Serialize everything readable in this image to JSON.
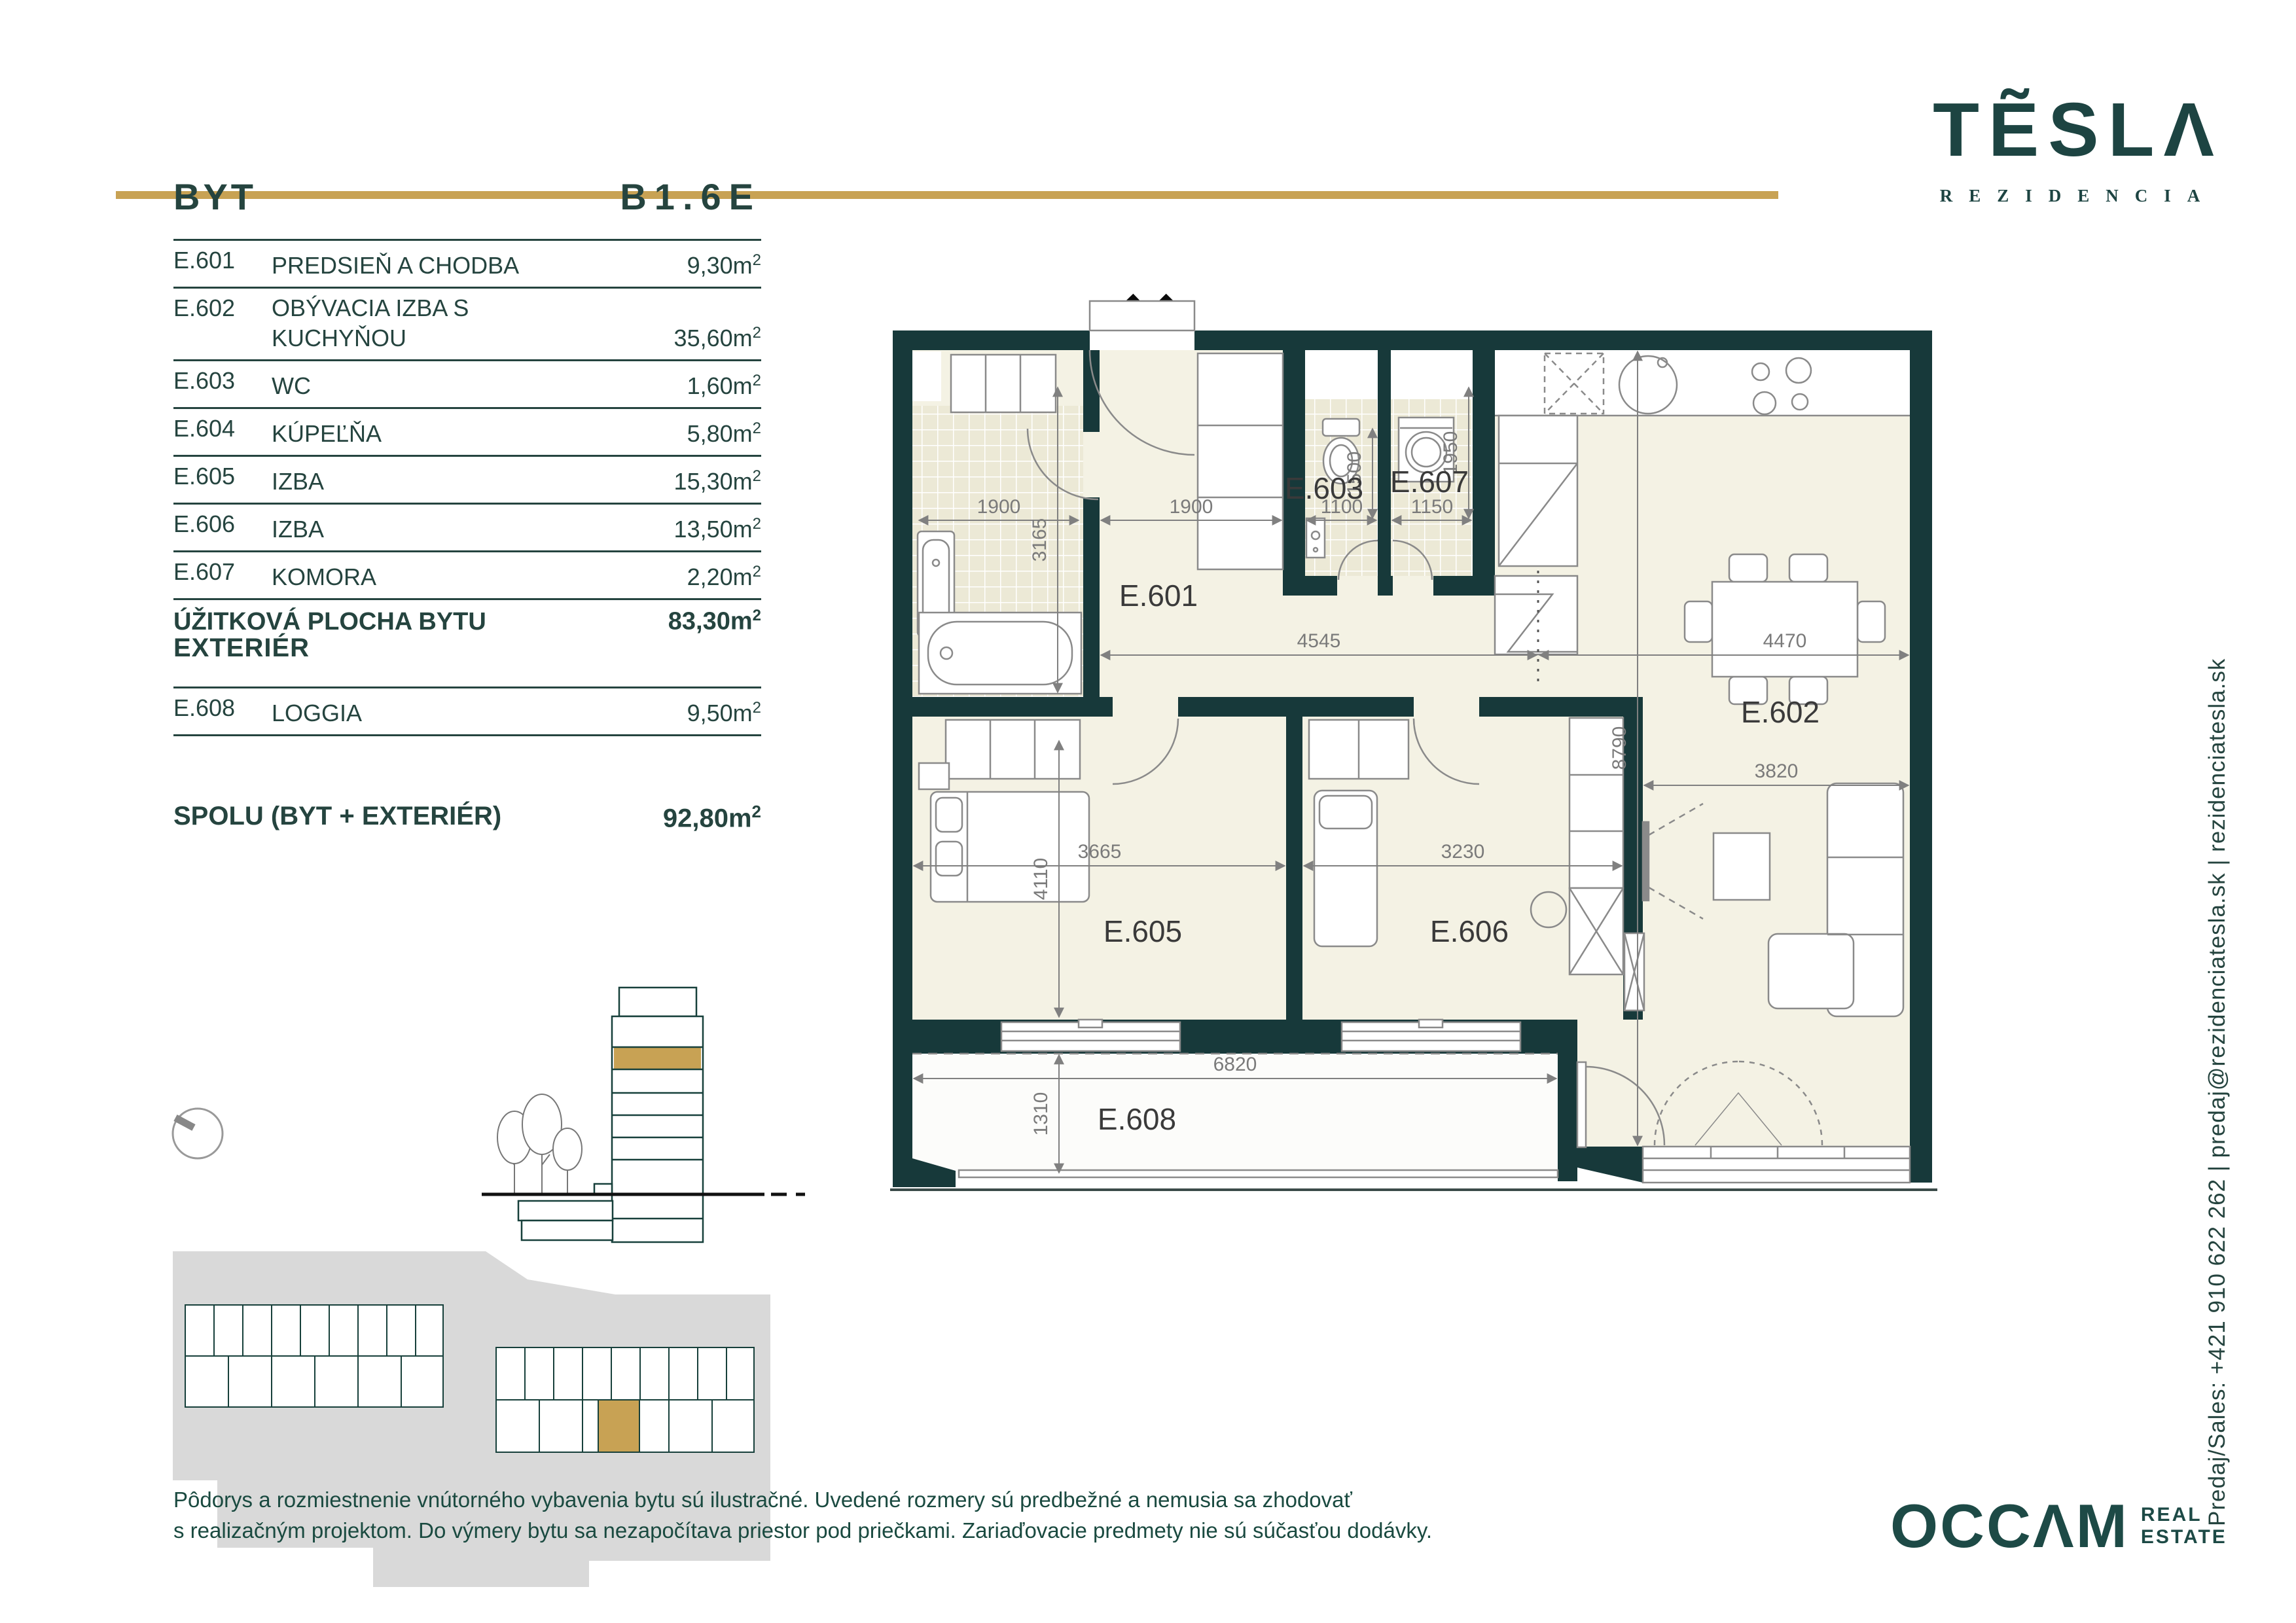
{
  "meta": {
    "unit": "m",
    "sup": "2"
  },
  "brand": {
    "logo_text": "TẼSLΛ",
    "logo_sub": "REZIDENCIA",
    "gold": "#C8A254",
    "teal_dark": "#17393A",
    "floor_color": "#F4F2E4"
  },
  "header": {
    "apartment_label": "BYT",
    "apartment_code": "B1.6E"
  },
  "rooms_table": {
    "rows": [
      {
        "code": "E.601",
        "name": "PREDSIEŇ A CHODBA",
        "area": "9,30"
      },
      {
        "code": "E.602",
        "name": "OBÝVACIA IZBA S KUCHYŇOU",
        "area": "35,60"
      },
      {
        "code": "E.603",
        "name": "WC",
        "area": "1,60"
      },
      {
        "code": "E.604",
        "name": "KÚPEĽŇA",
        "area": "5,80"
      },
      {
        "code": "E.605",
        "name": "IZBA",
        "area": "15,30"
      },
      {
        "code": "E.606",
        "name": "IZBA",
        "area": "13,50"
      },
      {
        "code": "E.607",
        "name": "KOMORA",
        "area": "2,20"
      }
    ],
    "total_label": "ÚŽITKOVÁ PLOCHA BYTU",
    "total_area": "83,30"
  },
  "exterior": {
    "section_label": "EXTERIÉR",
    "row": {
      "code": "E.608",
      "name": "LOGGIA",
      "area": "9,50"
    },
    "total_label": "SPOLU (BYT + EXTERIÉR)",
    "total_area": "92,80"
  },
  "plan": {
    "room_labels": {
      "e601": "E.601",
      "e602": "E.602",
      "e603": "E.603",
      "e605": "E.605",
      "e606": "E.606",
      "e607": "E.607",
      "e608": "E.608"
    },
    "dimensions": {
      "bath_w": "1900",
      "bath_d": "3165",
      "hall_w": "1900",
      "wc_w": "1100",
      "wc_d": "1500",
      "pantry_w": "1150",
      "pantry_d": "1950",
      "hall_len": "4545",
      "kitchen_len": "4470",
      "bed1_w": "3665",
      "bed1_d": "4110",
      "bed2_w": "3230",
      "living_d": "8790",
      "living_w": "3820",
      "loggia_w": "6820",
      "loggia_d": "1310"
    }
  },
  "contact": {
    "vertical_text": "Predaj/Sales: +421 910 622 262  |  predaj@rezidenciatesla.sk  |  rezidenciatesla.sk"
  },
  "footer": {
    "line1": "Pôdorys a rozmiestnenie vnútorného vybavenia bytu sú ilustračné. Uvedené rozmery sú predbežné a nemusia sa zhodovať",
    "line2": "s realizačným projektom. Do výmery bytu sa nezapočítava priestor pod priečkami. Zariaďovacie predmety nie sú súčasťou dodávky.",
    "agency": "OCCΛM",
    "agency_sub1": "REAL",
    "agency_sub2": "ESTATE"
  }
}
